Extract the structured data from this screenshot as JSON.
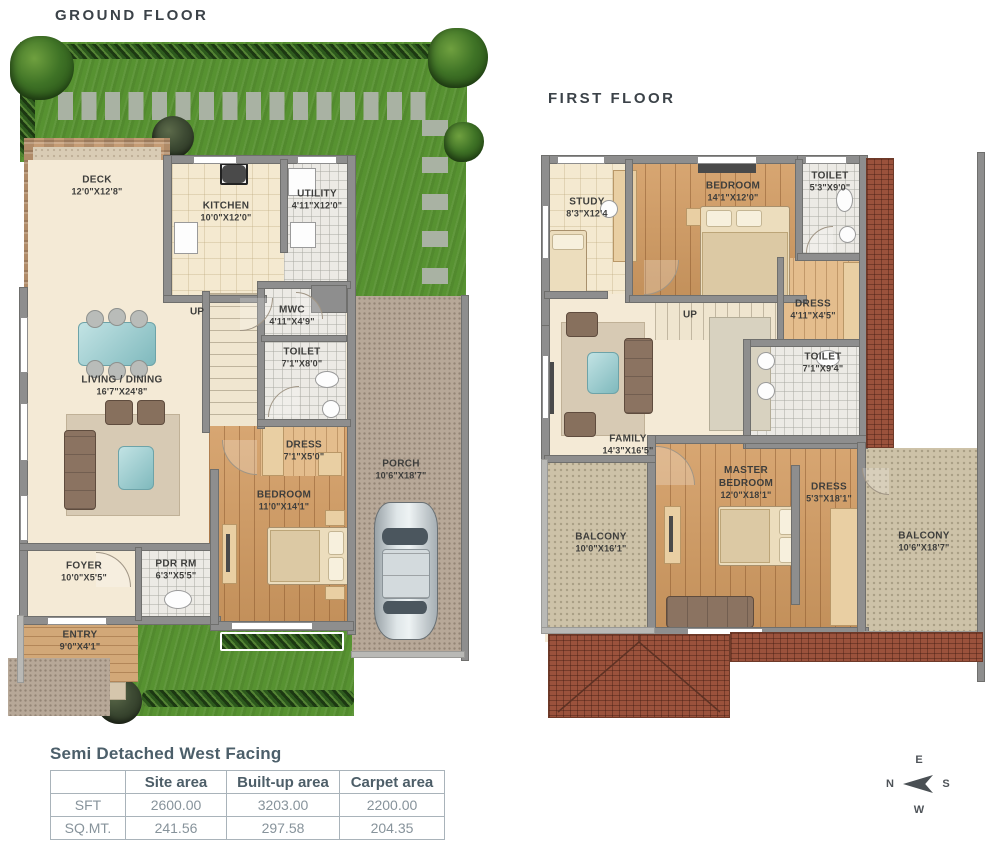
{
  "gf": {
    "title": "GROUND FLOOR",
    "up": "UP",
    "rooms": {
      "deck": {
        "name": "DECK",
        "dims": "12'0\"X12'8\""
      },
      "kitchen": {
        "name": "KITCHEN",
        "dims": "10'0\"X12'0\""
      },
      "utility": {
        "name": "UTILITY",
        "dims": "4'11\"X12'0\""
      },
      "mwc": {
        "name": "MWC",
        "dims": "4'11\"X4'9\""
      },
      "toilet": {
        "name": "TOILET",
        "dims": "7'1\"X8'0\""
      },
      "living": {
        "name": "LIVING / DINING",
        "dims": "16'7\"X24'8\""
      },
      "dress": {
        "name": "DRESS",
        "dims": "7'1\"X5'0\""
      },
      "bedroom": {
        "name": "BEDROOM",
        "dims": "11'0\"X14'1\""
      },
      "pdr": {
        "name": "PDR RM",
        "dims": "6'3\"X5'5\""
      },
      "foyer": {
        "name": "FOYER",
        "dims": "10'0\"X5'5\""
      },
      "entry": {
        "name": "ENTRY",
        "dims": "9'0\"X4'1\""
      },
      "porch": {
        "name": "PORCH",
        "dims": "10'6\"X18'7\""
      }
    }
  },
  "ff": {
    "title": "FIRST FLOOR",
    "up": "UP",
    "rooms": {
      "study": {
        "name": "STUDY",
        "dims": "8'3\"X12'4"
      },
      "bedroom": {
        "name": "BEDROOM",
        "dims": "14'1\"X12'0\""
      },
      "toilet_top": {
        "name": "TOILET",
        "dims": "5'3\"X9'0\""
      },
      "dress_top": {
        "name": "DRESS",
        "dims": "4'11\"X4'5\""
      },
      "toilet_mid": {
        "name": "TOILET",
        "dims": "7'1\"X9'4\""
      },
      "family": {
        "name": "FAMILY",
        "dims": "14'3\"X16'5\""
      },
      "master": {
        "name": "MASTER BEDROOM",
        "dims": "12'0\"X18'1\""
      },
      "dress_master": {
        "name": "DRESS",
        "dims": "5'3\"X18'1\""
      },
      "balcony_left": {
        "name": "BALCONY",
        "dims": "10'0\"X16'1\""
      },
      "balcony_right": {
        "name": "BALCONY",
        "dims": "10'6\"X18'7\""
      }
    }
  },
  "spec": {
    "title": "Semi Detached West Facing",
    "col_site": "Site area",
    "col_builtup": "Built-up area",
    "col_carpet": "Carpet area",
    "rows": [
      {
        "label": "SFT",
        "site": "2600.00",
        "builtup": "3203.00",
        "carpet": "2200.00"
      },
      {
        "label": "SQ.MT.",
        "site": "241.56",
        "builtup": "297.58",
        "carpet": "204.35"
      }
    ]
  },
  "compass": {
    "e": "E",
    "n": "N",
    "s": "S",
    "w": "W"
  },
  "palette": {
    "grass": "#579231",
    "wood": "#d39c62",
    "roof_brick": "#9b523c",
    "wall": "#8e8e8e",
    "teal_accent": "#8fc4c8",
    "gravel": "#b7a898",
    "cream": "#f4ead6"
  }
}
